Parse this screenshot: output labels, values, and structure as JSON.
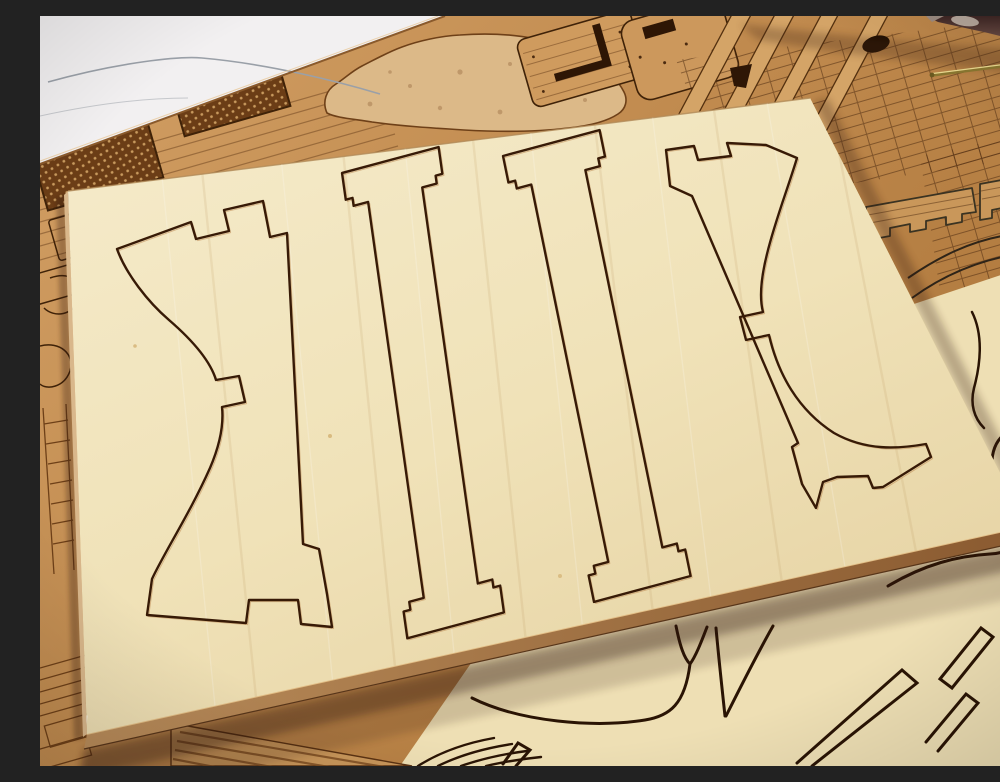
{
  "scene": {
    "type": "photograph",
    "subject": "Laser-cut wooden ship model kit sheets on a workbench",
    "description": "A pale plywood sheet with four laser-cut parts lies on top of tan laser-engraved kit sheets and a printed plan; a tool handle and a brass wire rod rest at the top right.",
    "foreground_sheet": {
      "name": "pale plywood part sheet",
      "piece_count": 4,
      "pieces": [
        "curved knee bracket with tenons (left)",
        "straight strip with tenon ends (inner left)",
        "straight strip with tenon ends (inner right)",
        "curved knee bracket with tenons (right, mirrored)"
      ]
    },
    "background": {
      "items": [
        "white plan drawing paper with hull outline",
        "tan deck sheet with engraved grating panels",
        "engraved plank and brick patterns",
        "island-shaped speckled cutout",
        "deck houses with slot cutouts",
        "diagonal batten strips",
        "notched rail strips with teeth",
        "oval cut hole"
      ]
    },
    "lower_right_sheet": {
      "name": "second pale sheet",
      "items": [
        "bowl-shaped arc cut",
        "Y-fork cut",
        "V-wedge cut",
        "slanted batten outlines",
        "U-slot part",
        "parallel plank arcs"
      ]
    },
    "lower_left_sheet": {
      "name": "striped tan sheet corner",
      "items": [
        "diagonal engraved stripes"
      ]
    },
    "tools": [
      "dark tool handle at top edge",
      "brass wire rod"
    ],
    "palette": {
      "paper": "#f2f0f1",
      "planline": "#9aa0a8",
      "bgTan1": "#d3a065",
      "bgTan2": "#c08a4e",
      "bgTan3": "#ab7438",
      "engrave": "#6e4018",
      "engraveDark": "#3f2208",
      "gratingDark": "#6b3d16",
      "gratingDot": "#c89a5e",
      "islandFill": "#dcb988",
      "stripFill": "#d4a467",
      "sheetCream1": "#f5ebcb",
      "sheetCream2": "#e6d3a4",
      "cutLine": "#371a06",
      "cutGlow": "#b9824a",
      "edgeFace1": "#b98c5a",
      "edgeFace2": "#8a5a30",
      "edgeHi": "#e2bd85",
      "edgeSeam": "#573519",
      "sheet2Fill": "#eedfb4",
      "sheet2Cut": "#2a1404",
      "stripesSheet": "#c8965a",
      "stripeLine": "#7d4e22",
      "toolDark": "#3e2624",
      "toolMid": "#7a5a50",
      "toolLight": "#c0b2a6",
      "brass": "#8a7730",
      "brassHi": "#ead98f",
      "shadow": "#2e1808"
    }
  }
}
